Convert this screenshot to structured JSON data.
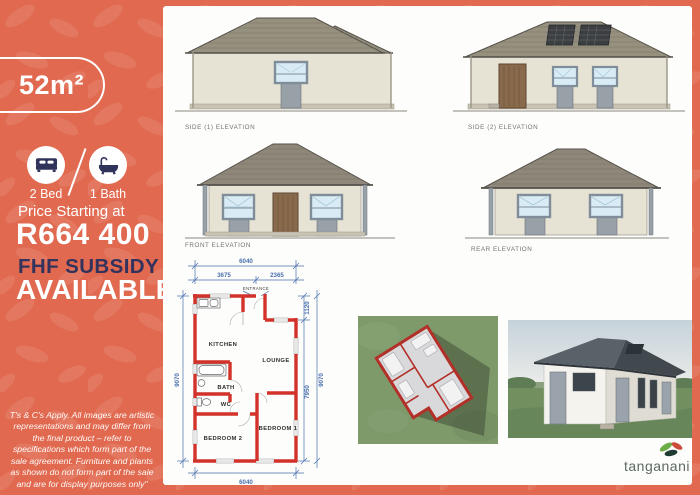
{
  "sidebar": {
    "area": "52m²",
    "features": [
      {
        "icon": "bed-icon",
        "label": "2 Bed"
      },
      {
        "icon": "bath-icon",
        "label": "1 Bath"
      }
    ],
    "price_label": "Price Starting at",
    "price": "R664 400",
    "subsidy_line1": "FHF SUBSIDY",
    "subsidy_line2": "AVAILABLE",
    "disclaimer": "T's & C's Apply. All images are artistic representations and may differ from the final product – refer to specifications which form part of the sale agreement. Furniture and plants as shown do not form part of the sale and are for display purposes only\""
  },
  "elevations": [
    {
      "label": "SIDE (1) ELEVATION"
    },
    {
      "label": "SIDE (2) ELEVATION"
    },
    {
      "label": "FRONT ELEVATION"
    },
    {
      "label": "REAR ELEVATION"
    }
  ],
  "floor_plan": {
    "entrance_label": "ENTRANCE",
    "rooms": [
      "KITCHEN",
      "LOUNGE",
      "BATH",
      "WC",
      "BEDROOM 1",
      "BEDROOM 2"
    ],
    "dims": {
      "width_total": "6040",
      "width_left": "3675",
      "width_right": "2365",
      "height_left": "9070",
      "right_top": "1120",
      "right_main": "7950",
      "right_total": "9070",
      "width_bottom": "6040"
    }
  },
  "brand": {
    "name": "tanganani"
  },
  "colors": {
    "background": "#e0694f",
    "navy": "#32325c",
    "wall_red": "#d2322a",
    "dim_blue": "#4a6fae",
    "roof": "#96907f",
    "card": "#fdfdfb"
  }
}
